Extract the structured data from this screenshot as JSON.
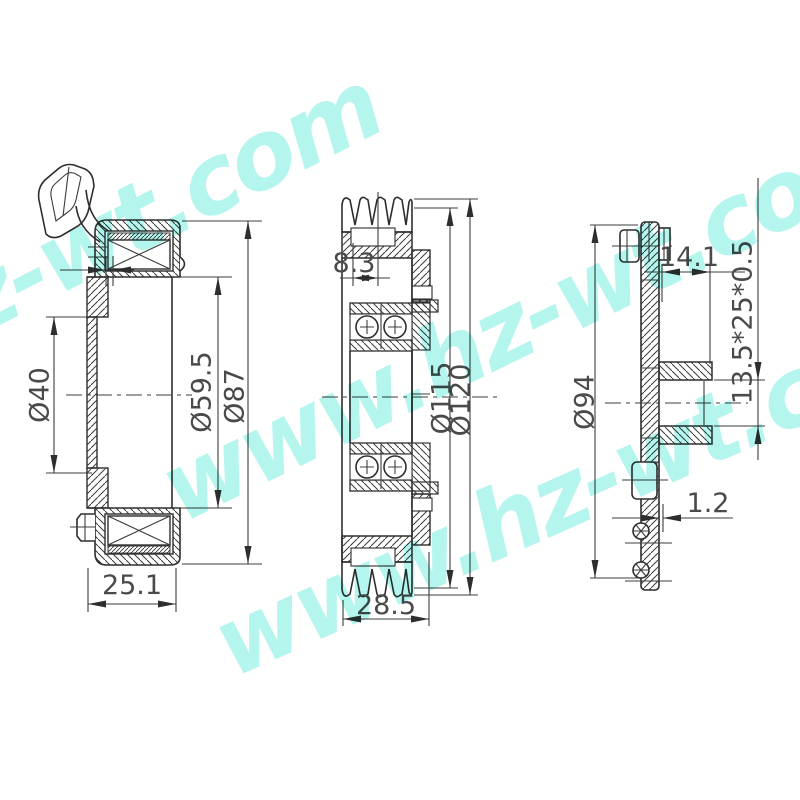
{
  "watermark": {
    "text": "www.hz-wt.com",
    "color": "#7deee0"
  },
  "views": {
    "left": {
      "title": "coil-side-view",
      "dims": {
        "d40": "Ø40",
        "d59_5": "Ø59.5",
        "d87": "Ø87",
        "width": "25.1"
      }
    },
    "middle": {
      "title": "pulley-section-view",
      "dims": {
        "groove": "8.3",
        "d115": "Ø115",
        "d120": "Ø120",
        "width": "28.5"
      }
    },
    "right": {
      "title": "plate-side-view",
      "dims": {
        "hub_depth": "14.1",
        "spec": "13.5*25*0.5",
        "d94": "Ø94",
        "gap": "1.2"
      }
    }
  }
}
